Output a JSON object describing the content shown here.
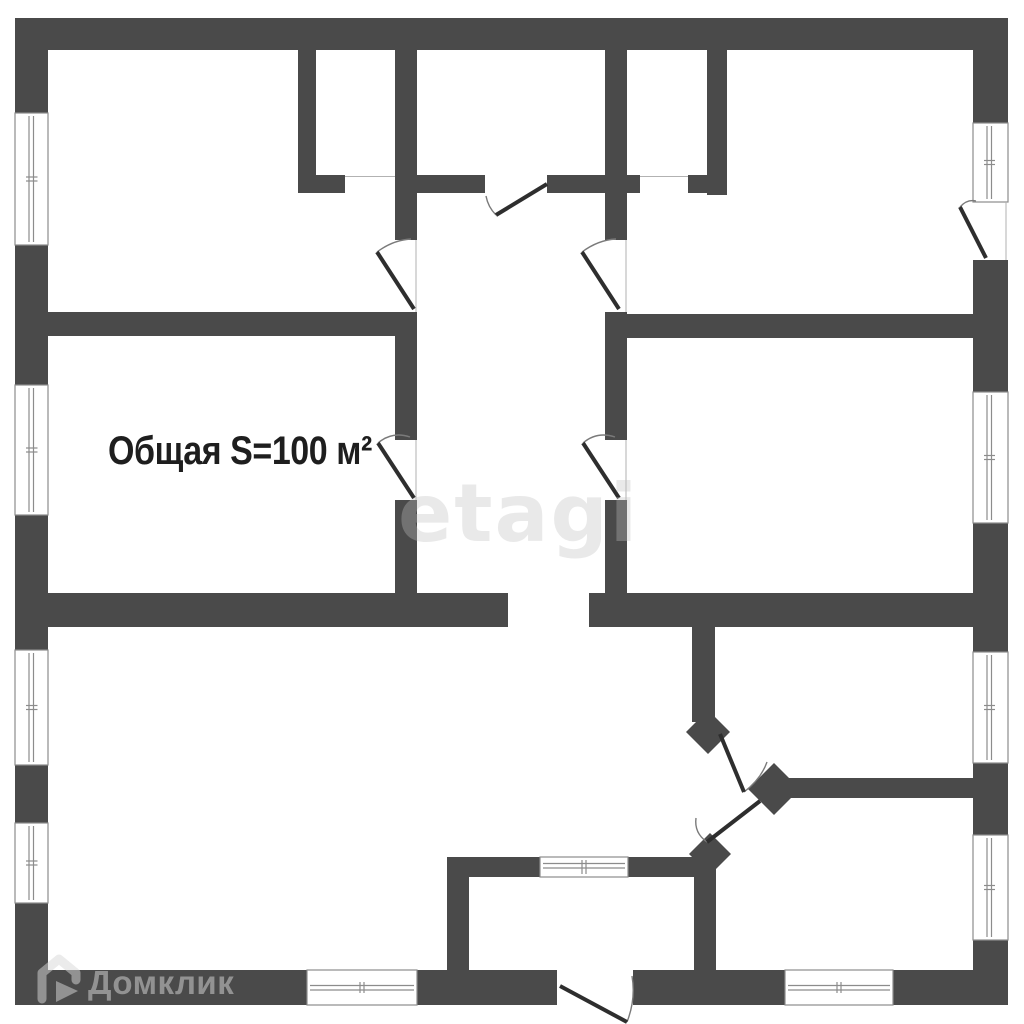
{
  "document": {
    "kind": "apartment-floor-plan"
  },
  "colors": {
    "background": "#ffffff",
    "wall": "#4a4a4a",
    "door_leaf": "#2e2e2e",
    "swing_arc": "#7a7a7a",
    "window_frame": "#8c8c8c",
    "opening_line": "#b2b2b2",
    "area_text": "#1e1e1e",
    "watermark_text": "#bfbfbf",
    "brand_text": "#d9d9d9"
  },
  "plan": {
    "area_label": "Общая S=100 м²",
    "total_area_value": "100",
    "area_units": "м²"
  },
  "watermark": {
    "site": "etagi"
  },
  "brand": {
    "name": "Домклик",
    "icon": "house-icon"
  }
}
